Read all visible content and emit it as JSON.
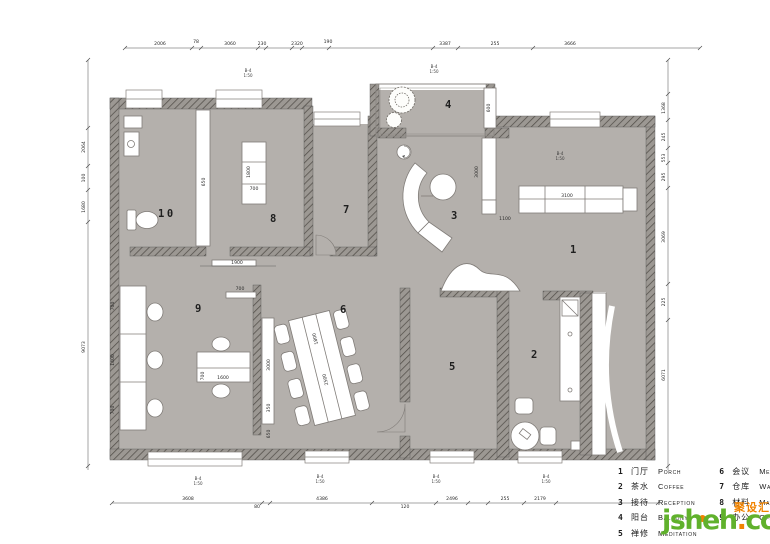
{
  "legend": {
    "items_left": [
      {
        "num": "1",
        "cn": "门厅",
        "en": "Porch"
      },
      {
        "num": "2",
        "cn": "茶水",
        "en": "Coffee"
      },
      {
        "num": "3",
        "cn": "接待",
        "en": "Reception"
      },
      {
        "num": "4",
        "cn": "阳台",
        "en": "Balcony"
      },
      {
        "num": "5",
        "cn": "禅修",
        "en": "Meditation"
      }
    ],
    "items_right": [
      {
        "num": "6",
        "cn": "会议",
        "en": "Meeting"
      },
      {
        "num": "7",
        "cn": "仓库",
        "en": "Warehouse"
      },
      {
        "num": "8",
        "cn": "材料",
        "en": "Material"
      },
      {
        "num": "9",
        "cn": "办公",
        "en": "Office"
      }
    ]
  },
  "watermark": {
    "name": "jsheh",
    "dot": ".",
    "tld": "com",
    "cn": "聚设汇"
  },
  "rooms": {
    "r1": "1",
    "r2": "2",
    "r3": "3",
    "r4": "4",
    "r5": "5",
    "r6": "6",
    "r7": "7",
    "r8": "8",
    "r9": "9",
    "r10": "10"
  },
  "dims": {
    "top": [
      "2006",
      "78",
      "3060",
      "230",
      "2320",
      "190",
      "3387",
      "255",
      "3666"
    ],
    "bottom": [
      "3608",
      "80",
      "4386",
      "120",
      "2496",
      "255",
      "2179"
    ],
    "left": [
      "2064",
      "100",
      "1680",
      "9073"
    ],
    "right": [
      "1368",
      "245",
      "553",
      "295",
      "3069",
      "225",
      "6071"
    ],
    "inner": [
      "650",
      "1800",
      "700",
      "1900",
      "700",
      "3000",
      "350",
      "650",
      "1600",
      "700",
      "2500",
      "1800",
      "1100",
      "3100",
      "600",
      "3000",
      "700",
      "1400",
      "700"
    ]
  },
  "markers": {
    "l1": "B-4",
    "l2": "1:50"
  },
  "colors": {
    "floor": "#b4b0ac",
    "wall_base": "#9c9893",
    "wall_line": "#524e49",
    "accent_green": "#60b12c",
    "accent_orange": "#f08300"
  }
}
